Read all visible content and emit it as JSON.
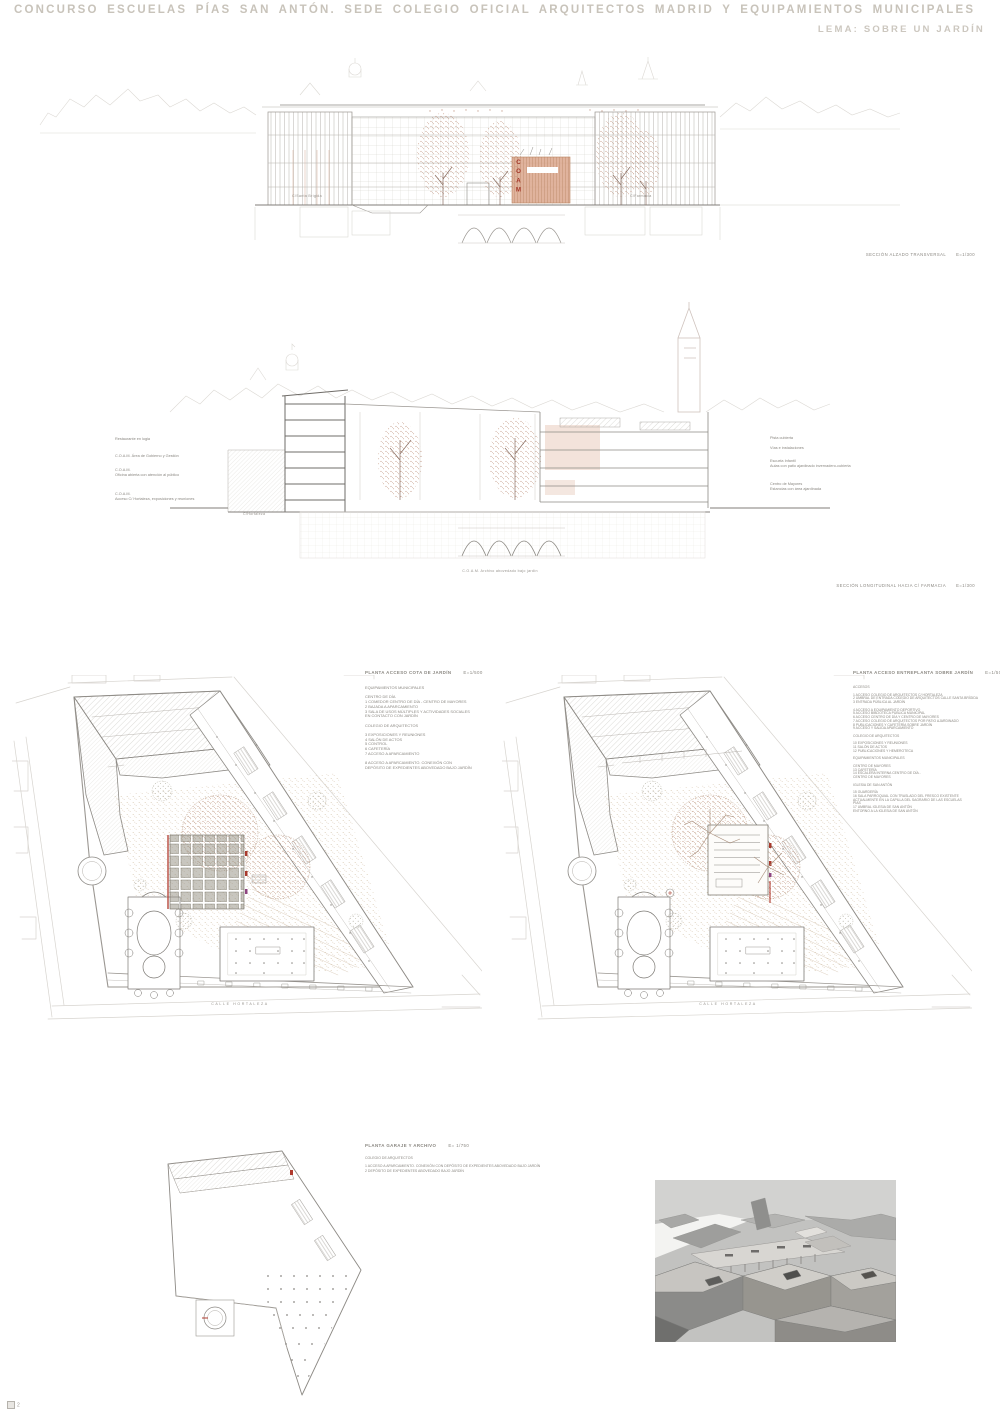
{
  "header": {
    "title": "CONCURSO ESCUELAS PÍAS SAN ANTÓN. SEDE COLEGIO OFICIAL ARQUITECTOS MADRID Y EQUIPAMIENTOS MUNICIPALES",
    "lema": "LEMA: SOBRE UN JARDÍN"
  },
  "drawings": {
    "transversal": {
      "caption": "SECCIÓN ALZADO TRANSVERSAL",
      "scale": "E=1/300",
      "street_left": "C/Santa Brígida",
      "street_right": "C/Farmacia",
      "coam_sign": "COAM"
    },
    "longitudinal": {
      "caption": "SECCIÓN LONGITUDINAL HACIA C/ FARMACIA",
      "scale": "E=1/300",
      "street": "C/Hortaleza",
      "caption_below": "C.O.A.M. Archivo abovedado bajo jardín",
      "notes_left": [
        "Restaurante en logia",
        "C.O.A.M. Área de Gobierno y Gestión",
        "C.O.A.M.\nOficina abierta con atención al público",
        "C.O.A.M.\nAcceso C/ Hortaleza, exposiciones y reuniones"
      ],
      "notes_right": [
        "Pista cubierta",
        "Vías e instalaciones",
        "Escuela Infantil\nAulas con patio ajardinado invernadero-cubierta",
        "Centro de Mayores\nEstancias con área ajardinada"
      ]
    },
    "plan_jardin": {
      "title": "PLANTA ACCESO COTA DE JARDÍN",
      "scale": "E=1/500",
      "street": "CALLE HORTALEZA",
      "legend": [
        "EQUIPAMIENTOS MUNICIPALES",
        "",
        "CENTRO DE DÍA",
        "1 COMEDOR CENTRO DE DÍA - CENTRO DE MAYORES",
        "2 BAJADA A APARCAMIENTO",
        "3 SALA DE USOS MÚLTIPLES Y ACTIVIDADES SOCIALES",
        "EN CONTACTO CON JARDÍN",
        "",
        "COLEGIO DE ARQUITECTOS",
        "",
        "3 EXPOSICIONES Y REUNIONES",
        "4 SALÓN DE ACTOS",
        "5 CONTROL",
        "6 CAFETERÍA",
        "7 ACCESO A APARCAMIENTO",
        "",
        "8 ACCESO A APARCAMIENTO. CONEXIÓN CON",
        "DEPÓSITO DE EXPEDIENTES ABOVEDADO BAJO JARDÍN"
      ]
    },
    "plan_entreplanta": {
      "title": "PLANTA ACCESO ENTREPLANTA SOBRE JARDÍN",
      "scale": "E=1/500",
      "street": "CALLE HORTALEZA",
      "legend": [
        "ACCESOS",
        "",
        "1 ACCESO COLEGIO DE ARQUITECTOS C/ HORTALEZA",
        "2 UMBRAL DE ENTRADA COLEGIO DE ARQUITECTOS CALLE SANTA BRÍGIDA",
        "3 ENTRADA PÚBLICA AL JARDÍN",
        "",
        "4 ACCESO A EQUIPAMIENTO DEPORTIVO",
        "5 ACCESO BIBLIOTECA PÚBLICA MUNICIPAL",
        "6 ACCESO CENTRO DE DÍA Y CENTRO DE MAYORES",
        "7 ACCESO COLEGIO DE ARQUITECTOS POR PATIO AJARDINADO",
        "8 PUBLICACIONES Y CAFETERÍA SOBRE JARDÍN",
        "9 ACCESO Y SALIDA APARCAMIENTO",
        "",
        "COLEGIO DE ARQUITECTOS",
        "",
        "10 EXPOSICIONES Y REUNIONES",
        "11 SALÓN DE ACTOS",
        "12 PUBLICACIONES Y HEMEROTECA",
        "",
        "EQUIPAMIENTOS MUNICIPALES",
        "",
        "CENTRO DE MAYORES",
        "13 CAFETERÍA",
        "14 ESCALERA INTERNA CENTRO DE DÍA -",
        "CENTRO DE MAYORES",
        "",
        "IGLESIA DE SAN ANTÓN",
        "",
        "15 GUARDERÍA",
        "16 SALA PARROQUIAL CON TRASLADO DEL FRESCO EXISTENTE",
        "ACTUALMENTE EN LA CAPILLA DEL SAGRARIO DE LAS ESCUELAS",
        "PÍAS",
        "17 UMBRAL IGLESIA DE SAN ANTÓN",
        "ENTORNO A LA IGLESIA DE SAN ANTÓN"
      ]
    },
    "plan_garaje": {
      "title": "PLANTA GARAJE Y ARCHIVO",
      "scale": "E= 1/750",
      "legend": [
        "COLEGIO DE ARQUITECTOS",
        "",
        "1 ACCESO A APARCAMIENTO. CONEXIÓN CON DEPÓSITO DE EXPEDIENTES ABOVEDADO BAJO JARDÍN",
        "2 DEPÓSITO DE EXPEDIENTES ABOVEDADO BAJO JARDÍN"
      ]
    }
  },
  "page": {
    "number": "2"
  },
  "colors": {
    "title_gray": "#c8c3ba",
    "line_gray": "#8d8a85",
    "tree_red": "#bd907b",
    "coam_panel": "#ddab92",
    "coam_letters": "#a5382a",
    "accent_red": "#b03a2e",
    "garden_beige": "#d9cab4"
  }
}
